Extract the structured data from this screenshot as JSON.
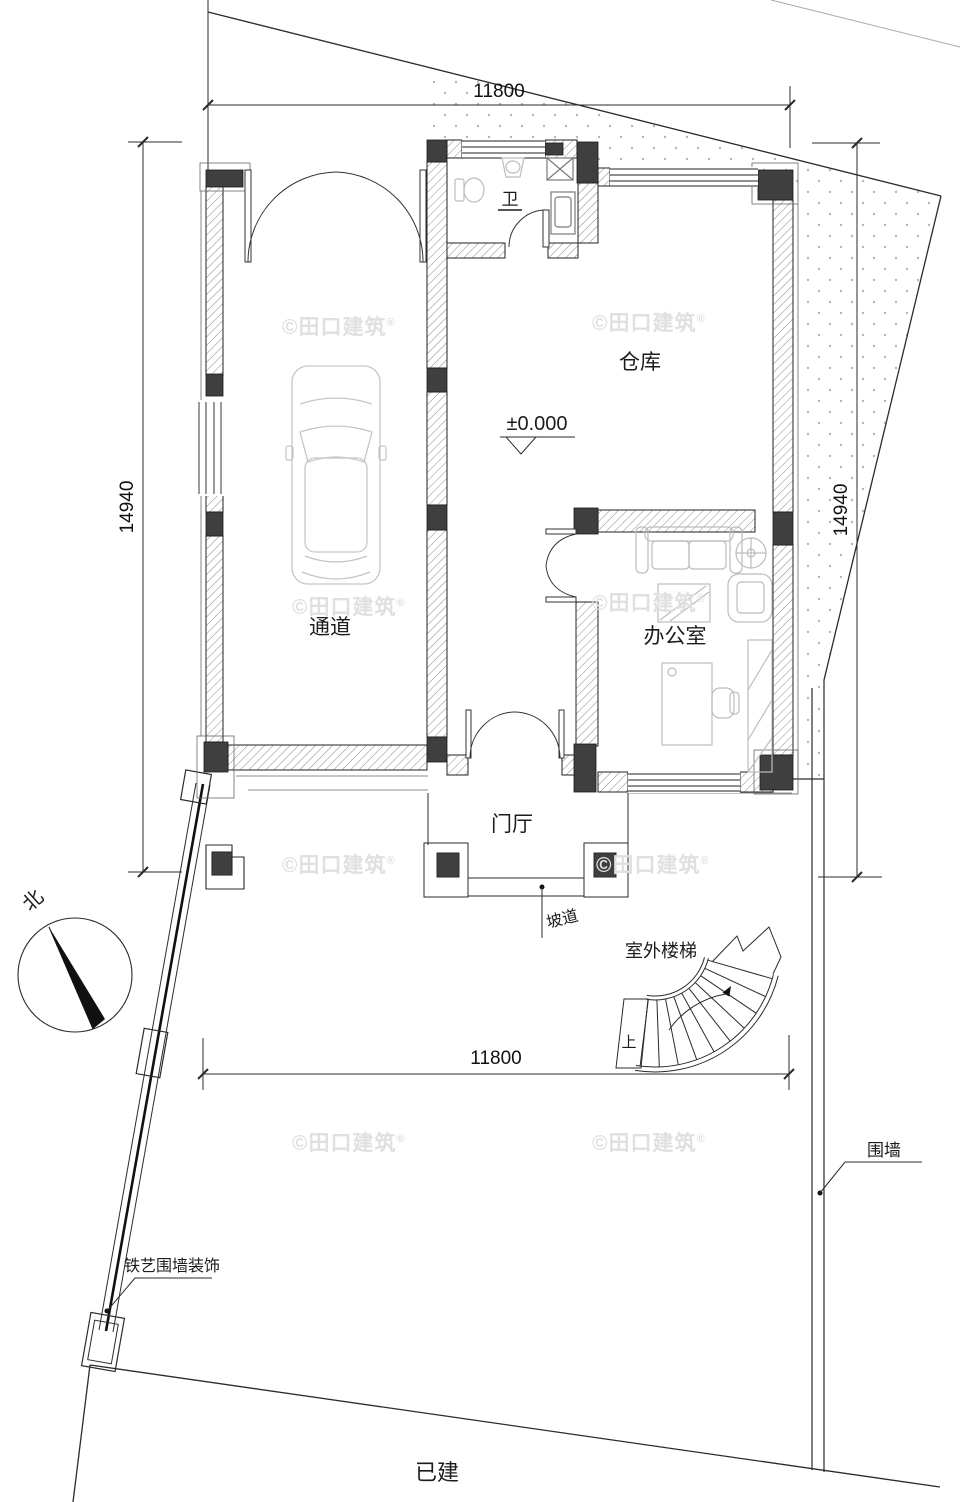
{
  "labels": {
    "rooms": {
      "passage": "通道",
      "warehouse": "仓库",
      "office": "办公室",
      "bathroom": "卫",
      "foyer": "门厅"
    },
    "features": {
      "ramp": "坡道",
      "outdoor_stairs": "室外楼梯",
      "stairs_up": "上",
      "fence": "围墙",
      "iron_fence_decor": "铁艺围墙装饰",
      "existing": "已建",
      "north": "北"
    },
    "level_marker": "±0.000"
  },
  "dimensions": {
    "top": "11800",
    "bottom": "11800",
    "left": "14940",
    "right": "14940"
  },
  "watermark": {
    "text": "©田口建筑",
    "reg": "®"
  },
  "colors": {
    "line": "#2b2b2b",
    "column_fill": "#3f3f3f",
    "stipple_dot": "#b6b6b6",
    "furniture": "#bcbcbc",
    "watermark": "#e0e0e0",
    "background": "#ffffff"
  }
}
